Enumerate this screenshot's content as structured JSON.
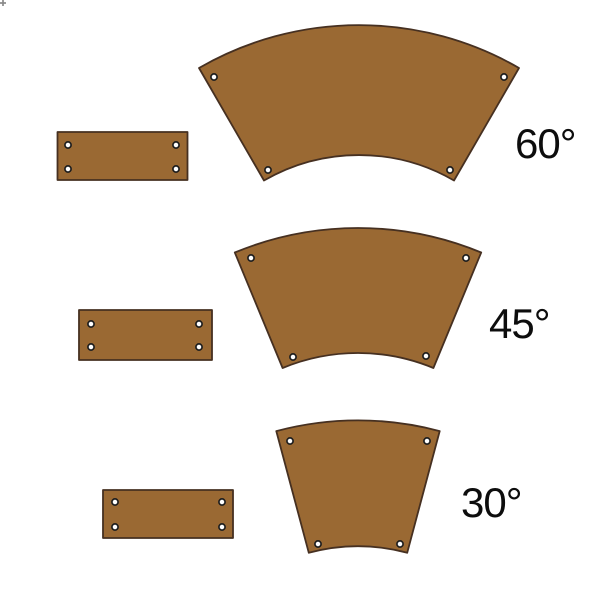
{
  "colors": {
    "canvas_bg": "#FFFFFF",
    "wood_fill": "#9A6933",
    "outline": "#463021",
    "hole_fill": "#FFFFFF",
    "hole_ring": "#1F1F1F",
    "label_color": "#0D0D0D",
    "artifact_gray": "#8A8A8A"
  },
  "rows": [
    {
      "angle_value": 60,
      "angle_label": "60°",
      "holes_per_piece": 4
    },
    {
      "angle_value": 45,
      "angle_label": "45°",
      "holes_per_piece": 4
    },
    {
      "angle_value": 30,
      "angle_label": "30°",
      "holes_per_piece": 4
    }
  ]
}
